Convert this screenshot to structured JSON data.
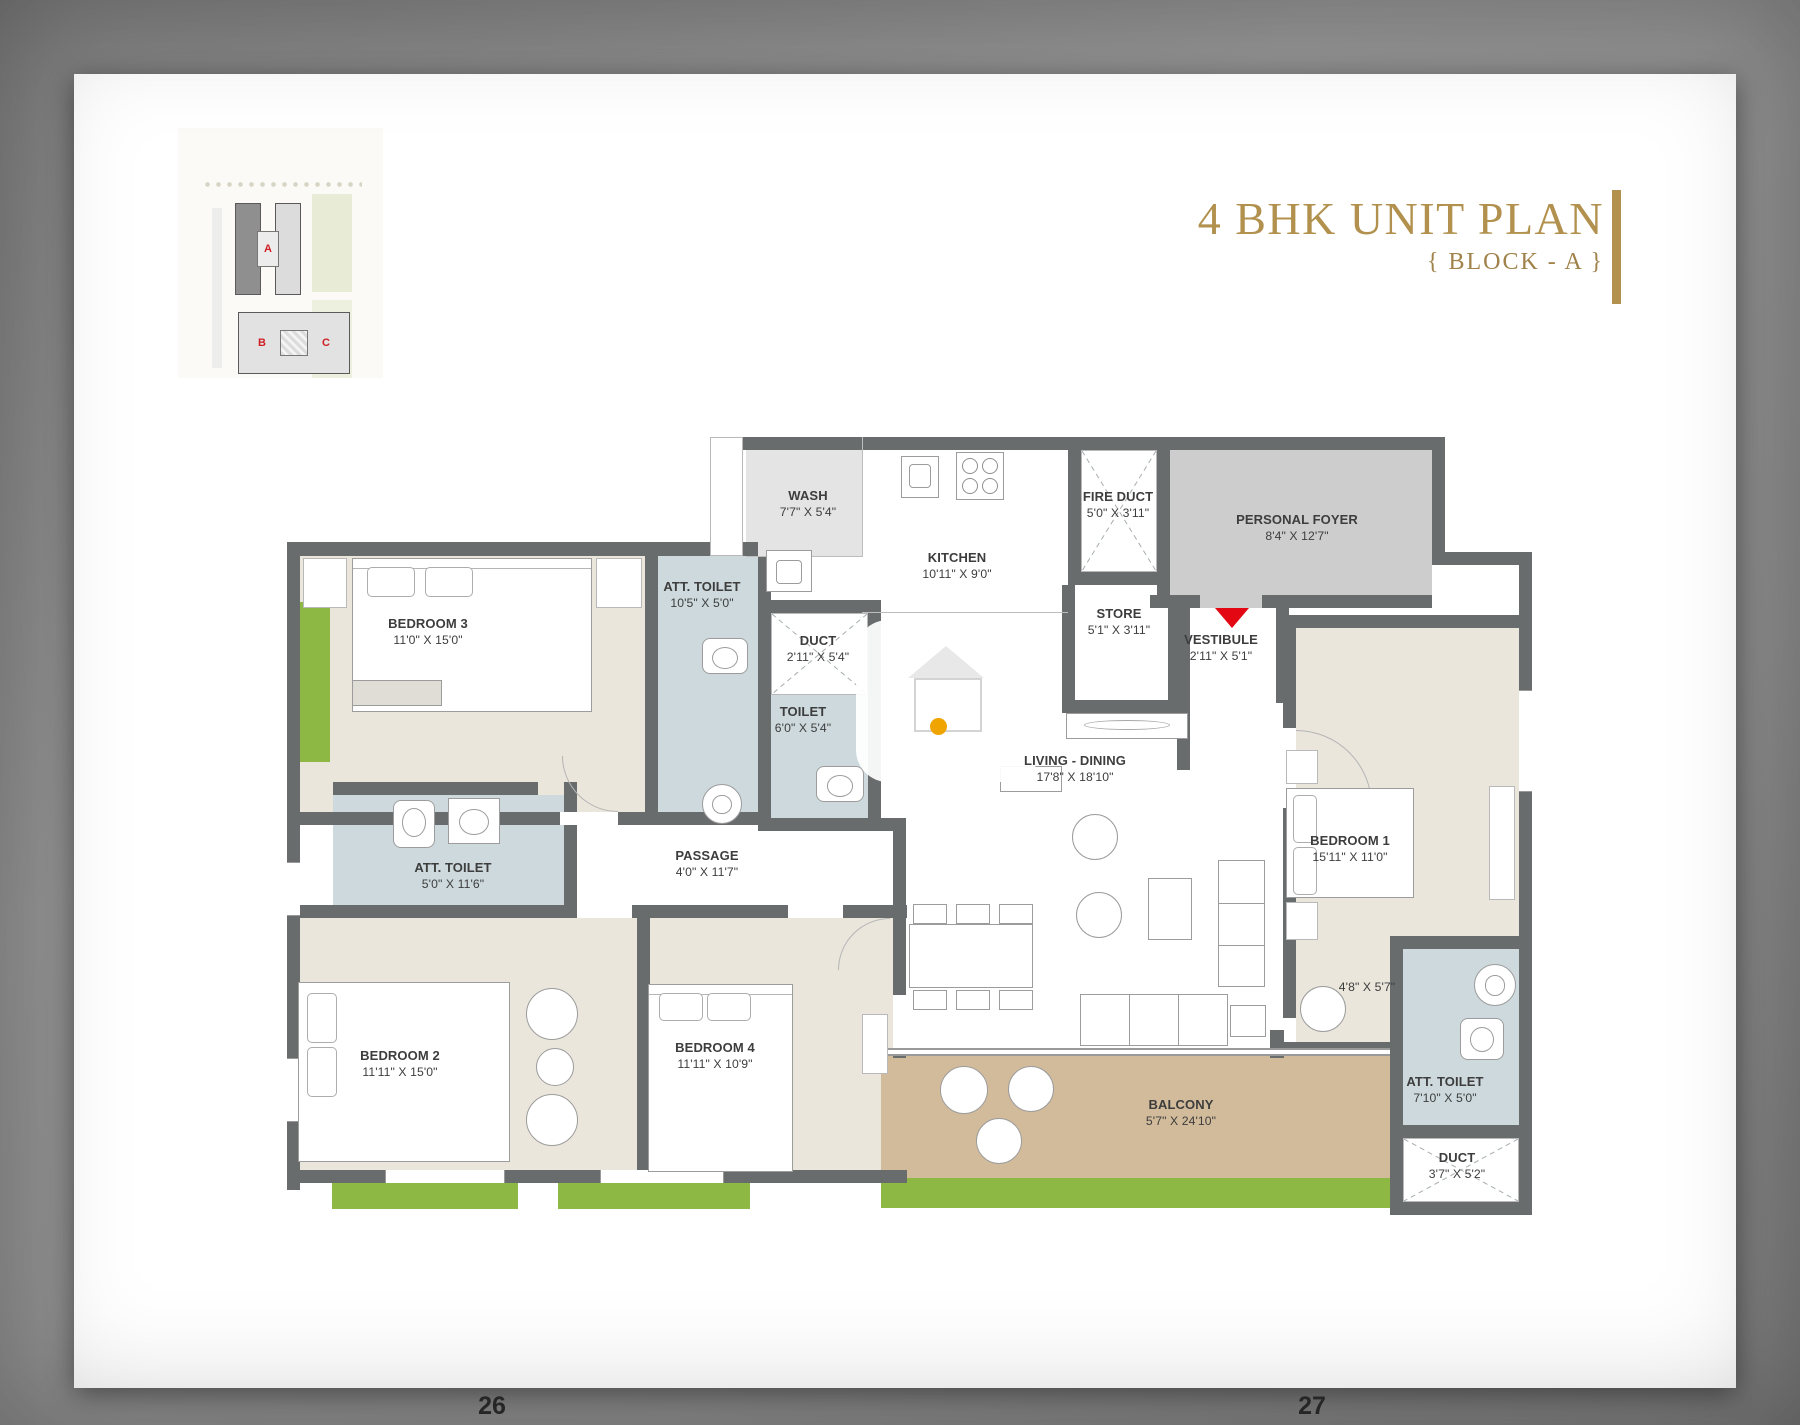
{
  "header": {
    "title": "4 BHK UNIT PLAN",
    "subtitle": "{ BLOCK - A }"
  },
  "key_plan": {
    "block_a": "A",
    "block_b": "B",
    "block_c": "C"
  },
  "page": {
    "left_number": "26",
    "right_number": "27"
  },
  "colors": {
    "title_gold": "#b2914e",
    "wall": "#696c6c",
    "floor_beige": "#eae6dc",
    "toilet_blue": "#cdd9dc",
    "foyer_gray": "#cdcdcd",
    "balcony_tan": "#d2bb9b",
    "grass_green": "#8cb843",
    "entry_red": "#e30613",
    "marker_yellow": "#f0a400"
  },
  "rooms": {
    "wash": {
      "name": "WASH",
      "dims": "7'7\" X 5'4\""
    },
    "kitchen": {
      "name": "KITCHEN",
      "dims": "10'11\" X 9'0\""
    },
    "fire_duct": {
      "name": "FIRE DUCT",
      "dims": "5'0\" X 3'11\""
    },
    "personal_foyer": {
      "name": "PERSONAL FOYER",
      "dims": "8'4\" X 12'7\""
    },
    "store": {
      "name": "STORE",
      "dims": "5'1\" X 3'11\""
    },
    "vestibule": {
      "name": "VESTIBULE",
      "dims": "2'11\" X 5'1\""
    },
    "att_toilet_bed3": {
      "name": "ATT. TOILET",
      "dims": "10'5\" X 5'0\""
    },
    "duct_kitchen": {
      "name": "DUCT",
      "dims": "2'11\" X 5'4\""
    },
    "toilet_common": {
      "name": "TOILET",
      "dims": "6'0\" X 5'4\""
    },
    "bedroom3": {
      "name": "BEDROOM 3",
      "dims": "11'0\" X 15'0\""
    },
    "living_dining": {
      "name": "LIVING - DINING",
      "dims": "17'8\" X 18'10\""
    },
    "bedroom1": {
      "name": "BEDROOM 1",
      "dims": "15'11\" X 11'0\""
    },
    "passage": {
      "name": "PASSAGE",
      "dims": "4'0\" X 11'7\""
    },
    "att_toilet_bed2": {
      "name": "ATT. TOILET",
      "dims": "5'0\" X 11'6\""
    },
    "bedroom2": {
      "name": "BEDROOM 2",
      "dims": "11'11\" X 15'0\""
    },
    "bedroom4": {
      "name": "BEDROOM 4",
      "dims": "11'11\" X 10'9\""
    },
    "balcony": {
      "name": "BALCONY",
      "dims": "5'7\" X 24'10\""
    },
    "att_toilet_bed1": {
      "name": "ATT. TOILET",
      "dims": "7'10\" X 5'0\""
    },
    "duct_corner": {
      "name": "DUCT",
      "dims": "3'7\" X 5'2\""
    },
    "bedroom1_dressing": {
      "dims": "4'8\" X 5'7\""
    }
  }
}
